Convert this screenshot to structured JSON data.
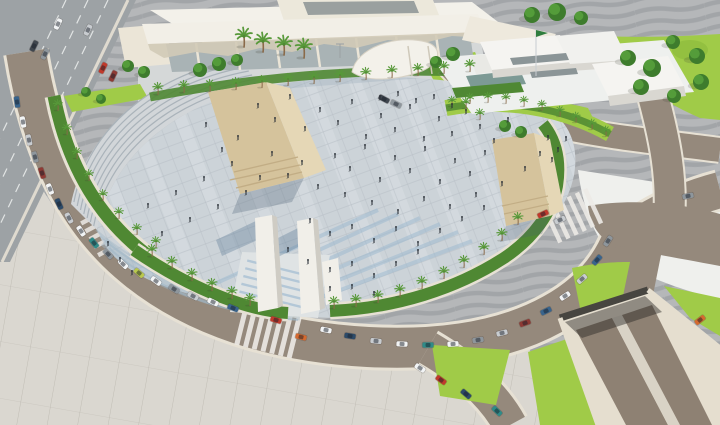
{
  "colors": {
    "bg": "#b5b7b9",
    "bgStripe": "#a2a5a8",
    "esp": "#dad7d0",
    "espLine": "#bab6ae",
    "plaza": "#ccd3d8",
    "plazaLine": "#b4bdc4",
    "plazaBand": "#e0e5e8",
    "road": "#95897c",
    "roadCasing": "#e7e1d4",
    "hw": "#9da2a5",
    "hwLine": "#eef0ef",
    "grass": "#a0cb48",
    "grassDk": "#83b437",
    "hedge": "#4f8833",
    "treeDk": "#3e7c2d",
    "treeLt": "#57a03c",
    "palm": "#58993a",
    "trunk": "#8a6a49",
    "bldg": "#ebe5d7",
    "roofLt": "#f3f1ea",
    "roofSh": "#d2cab7",
    "glass": "#a9b3b5",
    "white": "#f5f4f1",
    "whiteSh": "#d9d7d1",
    "stone": "#d5c39c",
    "stoneLt": "#e5d7b6",
    "stoneSh": "#c2ad85",
    "mono": "#f1efe9",
    "monoSh": "#cfccc4",
    "blueStripe": "#9bb9d0",
    "cascade": "#9fb6c6",
    "tunnelWall": "#e5decf",
    "tunnelRoad": "#8e8173",
    "tunnelMed": "#d9d3c6",
    "portal": "#474540",
    "cw": "#eceae6",
    "person": "#2b3138",
    "carDark": "#3f464e",
    "carGray": "#8e969c",
    "carSilver": "#c8ccd0",
    "carWhite": "#f2f4f5",
    "carRed": "#c03a2c",
    "carMaroon": "#8e3a34",
    "carOrange": "#d4692f",
    "carBlue": "#39648c",
    "carDarkBlue": "#2c4a68",
    "carTeal": "#2f8b88",
    "carLime": "#b9c94e",
    "flag": "#2f7d3e"
  },
  "scene": {
    "palms": [
      [
        158,
        94,
        1
      ],
      [
        184,
        92,
        1
      ],
      [
        210,
        91,
        1
      ],
      [
        236,
        89,
        1
      ],
      [
        262,
        87,
        1
      ],
      [
        288,
        85,
        1
      ],
      [
        314,
        83,
        1
      ],
      [
        340,
        81,
        1
      ],
      [
        366,
        79,
        1
      ],
      [
        392,
        77,
        1
      ],
      [
        418,
        75,
        1
      ],
      [
        444,
        73,
        1
      ],
      [
        470,
        71,
        1
      ],
      [
        244,
        46,
        1.6
      ],
      [
        263,
        51,
        1.6
      ],
      [
        284,
        54,
        1.6
      ],
      [
        304,
        57,
        1.6
      ],
      [
        58,
        110,
        0.9
      ],
      [
        67,
        134,
        0.9
      ],
      [
        77,
        158,
        0.9
      ],
      [
        89,
        180,
        0.9
      ],
      [
        103,
        200,
        0.9
      ],
      [
        119,
        218,
        0.9
      ],
      [
        137,
        234,
        0.9
      ],
      [
        156,
        247,
        0.9
      ],
      [
        152,
        256,
        1
      ],
      [
        172,
        268,
        1
      ],
      [
        192,
        280,
        1
      ],
      [
        212,
        290,
        1
      ],
      [
        232,
        298,
        1
      ],
      [
        250,
        305,
        1
      ],
      [
        334,
        308,
        1
      ],
      [
        356,
        306,
        1
      ],
      [
        378,
        302,
        1
      ],
      [
        400,
        296,
        1
      ],
      [
        422,
        288,
        1
      ],
      [
        444,
        278,
        1
      ],
      [
        464,
        267,
        1
      ],
      [
        484,
        254,
        1
      ],
      [
        502,
        240,
        1
      ],
      [
        518,
        224,
        1
      ],
      [
        466,
        108,
        0.9
      ],
      [
        480,
        119,
        0.9
      ],
      [
        452,
        106,
        0.85
      ],
      [
        470,
        103,
        0.85
      ],
      [
        488,
        102,
        0.85
      ],
      [
        506,
        103,
        0.85
      ],
      [
        524,
        106,
        0.85
      ],
      [
        542,
        110,
        0.85
      ],
      [
        560,
        116,
        0.85
      ],
      [
        576,
        122,
        0.85
      ],
      [
        592,
        129,
        0.85
      ],
      [
        606,
        136,
        0.85
      ]
    ],
    "trees": [
      [
        86,
        92,
        5
      ],
      [
        101,
        99,
        5
      ],
      [
        128,
        66,
        6
      ],
      [
        144,
        72,
        6
      ],
      [
        200,
        70,
        7
      ],
      [
        219,
        64,
        7
      ],
      [
        237,
        60,
        6
      ],
      [
        532,
        15,
        8
      ],
      [
        557,
        12,
        9
      ],
      [
        581,
        18,
        7
      ],
      [
        436,
        62,
        6
      ],
      [
        453,
        54,
        7
      ],
      [
        628,
        58,
        8
      ],
      [
        652,
        68,
        9
      ],
      [
        641,
        87,
        8
      ],
      [
        673,
        42,
        7
      ],
      [
        697,
        56,
        8
      ],
      [
        701,
        82,
        8
      ],
      [
        674,
        96,
        7
      ],
      [
        505,
        126,
        6
      ],
      [
        521,
        132,
        6
      ]
    ],
    "people": [
      [
        258,
        108
      ],
      [
        275,
        122
      ],
      [
        290,
        99
      ],
      [
        305,
        131
      ],
      [
        320,
        112
      ],
      [
        338,
        125
      ],
      [
        352,
        104
      ],
      [
        366,
        139
      ],
      [
        381,
        118
      ],
      [
        395,
        132
      ],
      [
        410,
        109
      ],
      [
        424,
        141
      ],
      [
        439,
        121
      ],
      [
        452,
        136
      ],
      [
        466,
        114
      ],
      [
        480,
        129
      ],
      [
        494,
        143
      ],
      [
        508,
        122
      ],
      [
        335,
        158
      ],
      [
        350,
        171
      ],
      [
        365,
        149
      ],
      [
        380,
        182
      ],
      [
        395,
        160
      ],
      [
        410,
        173
      ],
      [
        425,
        151
      ],
      [
        440,
        184
      ],
      [
        455,
        163
      ],
      [
        470,
        176
      ],
      [
        485,
        155
      ],
      [
        302,
        165
      ],
      [
        288,
        178
      ],
      [
        272,
        156
      ],
      [
        318,
        189
      ],
      [
        345,
        197
      ],
      [
        372,
        205
      ],
      [
        398,
        214
      ],
      [
        424,
        201
      ],
      [
        450,
        209
      ],
      [
        476,
        197
      ],
      [
        502,
        186
      ],
      [
        525,
        171
      ],
      [
        540,
        156
      ],
      [
        310,
        223
      ],
      [
        330,
        236
      ],
      [
        352,
        229
      ],
      [
        374,
        243
      ],
      [
        396,
        231
      ],
      [
        418,
        246
      ],
      [
        440,
        233
      ],
      [
        462,
        221
      ],
      [
        484,
        210
      ],
      [
        288,
        252
      ],
      [
        308,
        264
      ],
      [
        330,
        272
      ],
      [
        352,
        266
      ],
      [
        374,
        278
      ],
      [
        396,
        266
      ],
      [
        418,
        254
      ],
      [
        260,
        180
      ],
      [
        246,
        195
      ],
      [
        232,
        166
      ],
      [
        218,
        209
      ],
      [
        204,
        181
      ],
      [
        190,
        222
      ],
      [
        176,
        195
      ],
      [
        162,
        236
      ],
      [
        148,
        208
      ],
      [
        238,
        140
      ],
      [
        222,
        152
      ],
      [
        206,
        127
      ],
      [
        352,
        289
      ],
      [
        374,
        296
      ],
      [
        330,
        291
      ],
      [
        548,
        140
      ],
      [
        558,
        152
      ],
      [
        566,
        141
      ],
      [
        552,
        162
      ],
      [
        380,
        100
      ],
      [
        398,
        96
      ],
      [
        416,
        103
      ],
      [
        434,
        99
      ],
      [
        452,
        108
      ],
      [
        120,
        262
      ],
      [
        108,
        246
      ],
      [
        132,
        275
      ]
    ],
    "cars": [
      [
        34,
        46,
        116,
        "carDark"
      ],
      [
        45,
        54,
        116,
        "carGray"
      ],
      [
        58,
        24,
        116,
        "carWhite"
      ],
      [
        88,
        30,
        116,
        "carSilver"
      ],
      [
        103,
        68,
        116,
        "carRed"
      ],
      [
        113,
        76,
        116,
        "carMaroon"
      ],
      [
        17,
        102,
        82,
        "carBlue"
      ],
      [
        23,
        122,
        80,
        "carWhite"
      ],
      [
        29,
        140,
        78,
        "carSilver"
      ],
      [
        35,
        157,
        75,
        "carGray"
      ],
      [
        42,
        173,
        72,
        "carMaroon"
      ],
      [
        50,
        189,
        69,
        "carWhite"
      ],
      [
        59,
        204,
        66,
        "carDarkBlue"
      ],
      [
        69,
        218,
        62,
        "carSilver"
      ],
      [
        81,
        231,
        57,
        "carWhite"
      ],
      [
        94,
        243,
        52,
        "carTeal"
      ],
      [
        108,
        254,
        48,
        "carGray"
      ],
      [
        123,
        264,
        44,
        "carWhite"
      ],
      [
        139,
        273,
        40,
        "carLime"
      ],
      [
        156,
        281,
        36,
        "carWhite"
      ],
      [
        174,
        289,
        32,
        "carGray"
      ],
      [
        193,
        296,
        29,
        "carSilver"
      ],
      [
        213,
        302,
        26,
        "carWhite"
      ],
      [
        233,
        308,
        22,
        "carBlue"
      ],
      [
        276,
        320,
        16,
        "carRed"
      ],
      [
        301,
        337,
        14,
        "carOrange"
      ],
      [
        326,
        330,
        12,
        "carWhite"
      ],
      [
        350,
        336,
        9,
        "carDarkBlue"
      ],
      [
        376,
        341,
        6,
        "carSilver"
      ],
      [
        402,
        344,
        3,
        "carWhite"
      ],
      [
        428,
        345,
        0,
        "carTeal"
      ],
      [
        453,
        344,
        -4,
        "carWhite"
      ],
      [
        478,
        340,
        -9,
        "carGray"
      ],
      [
        502,
        333,
        -14,
        "carSilver"
      ],
      [
        525,
        323,
        -20,
        "carMaroon"
      ],
      [
        546,
        311,
        -26,
        "carBlue"
      ],
      [
        565,
        296,
        -33,
        "carWhite"
      ],
      [
        582,
        279,
        -41,
        "carSilver"
      ],
      [
        597,
        260,
        -49,
        "carBlue"
      ],
      [
        608,
        241,
        -57,
        "carGray"
      ],
      [
        560,
        220,
        -25,
        "carSilver"
      ],
      [
        543,
        214,
        -25,
        "carRed"
      ],
      [
        384,
        99,
        28,
        "carDark"
      ],
      [
        396,
        104,
        26,
        "carGray"
      ],
      [
        420,
        368,
        33,
        "carWhite"
      ],
      [
        441,
        380,
        36,
        "carRed"
      ],
      [
        466,
        394,
        40,
        "carDarkBlue"
      ],
      [
        497,
        411,
        44,
        "carTeal"
      ],
      [
        700,
        320,
        -38,
        "carOrange"
      ],
      [
        688,
        196,
        -12,
        "carGray"
      ]
    ]
  }
}
